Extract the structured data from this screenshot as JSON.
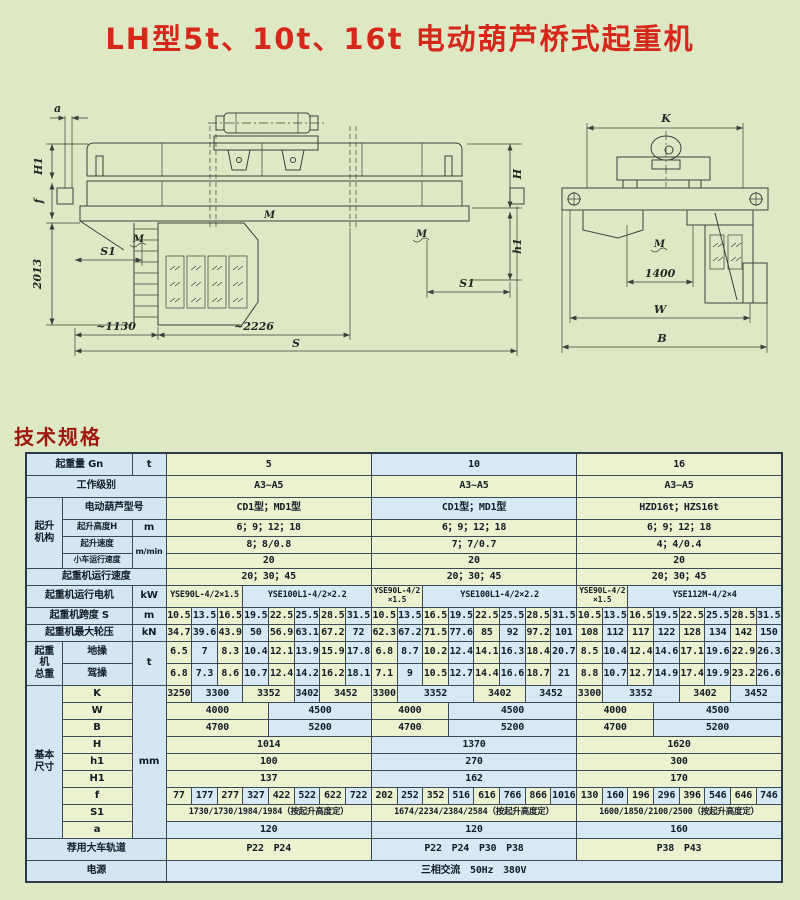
{
  "page": {
    "title": "LH型5t、10t、16t 电动葫芦桥式起重机",
    "section_heading": "技术规格"
  },
  "colors": {
    "page_bg": "#dfe8c5",
    "title_red": "#d6271b",
    "heading_red": "#9e170d",
    "cell_green": "#ecf1cf",
    "cell_blue": "#d6e9f4",
    "label_blue": "#d3e6f1",
    "border": "#3a4a57"
  },
  "drawing": {
    "left": {
      "a": "a",
      "h1dim": "H1",
      "f": "f",
      "d2013": "2013",
      "s1a": "S1",
      "s1b": "S1",
      "d1130": "~1130",
      "d2226": "~2226",
      "s": "S",
      "h": "H",
      "h1r": "h1",
      "m": "M"
    },
    "right": {
      "k": "K",
      "d1400": "1400",
      "w": "W",
      "b": "B",
      "m": "M"
    }
  },
  "table": {
    "rows": [
      [
        {
          "t": "起重量 Gn",
          "cs": 2,
          "c": "lab"
        },
        {
          "t": "t",
          "c": "lab"
        },
        {
          "t": "5",
          "cs": 8,
          "c": "g"
        },
        {
          "t": "10",
          "cs": 8,
          "c": "b"
        },
        {
          "t": "16",
          "cs": 8,
          "c": "g"
        }
      ],
      [
        {
          "t": "工作级别",
          "cs": 3,
          "c": "lab"
        },
        {
          "t": "A3~A5",
          "cs": 8,
          "c": "g"
        },
        {
          "t": "A3~A5",
          "cs": 8,
          "c": "g"
        },
        {
          "t": "A3~A5",
          "cs": 8,
          "c": "g"
        }
      ],
      [
        {
          "t": "起升\n机构",
          "rs": 4,
          "c": "lab"
        },
        {
          "t": "电动葫芦型号",
          "cs": 2,
          "c": "lab"
        },
        {
          "t": "CD1型；MD1型",
          "cs": 8,
          "c": "g"
        },
        {
          "t": "CD1型；MD1型",
          "cs": 8,
          "c": "b"
        },
        {
          "t": "HZD16t；HZS16t",
          "cs": 8,
          "c": "g"
        }
      ],
      [
        {
          "t": "起升高度H",
          "c": "lab sm"
        },
        {
          "t": "m",
          "c": "lab"
        },
        {
          "t": "6；9；12；18",
          "cs": 8,
          "c": "g"
        },
        {
          "t": "6；9；12；18",
          "cs": 8,
          "c": "g"
        },
        {
          "t": "6；9；12；18",
          "cs": 8,
          "c": "g"
        }
      ],
      [
        {
          "t": "起升速度",
          "c": "lab sm"
        },
        {
          "t": "m/min",
          "rs": 2,
          "c": "lab xs"
        },
        {
          "t": "8；8/0.8",
          "cs": 8,
          "c": "g"
        },
        {
          "t": "7；7/0.7",
          "cs": 8,
          "c": "g"
        },
        {
          "t": "4；4/0.4",
          "cs": 8,
          "c": "g"
        }
      ],
      [
        {
          "t": "小车运行速度",
          "c": "lab xs"
        },
        {
          "t": "20",
          "cs": 8,
          "c": "g"
        },
        {
          "t": "20",
          "cs": 8,
          "c": "g"
        },
        {
          "t": "20",
          "cs": 8,
          "c": "g"
        }
      ],
      [
        {
          "t": "起重机运行速度",
          "cs": 3,
          "c": "lab"
        },
        {
          "t": "20；30；45",
          "cs": 8,
          "c": "g"
        },
        {
          "t": "20；30；45",
          "cs": 8,
          "c": "g"
        },
        {
          "t": "20；30；45",
          "cs": 8,
          "c": "g"
        }
      ],
      [
        {
          "t": "起重机运行电机",
          "cs": 2,
          "c": "lab"
        },
        {
          "t": "kW",
          "c": "lab"
        },
        {
          "t": "YSE90L-4/2×1.5",
          "cs": 3,
          "c": "g sm"
        },
        {
          "t": "YSE100L1-4/2×2.2",
          "cs": 5,
          "c": "b sm"
        },
        {
          "t": "YSE90L-4/2\n×1.5",
          "cs": 2,
          "c": "g xs"
        },
        {
          "t": "YSE100L1-4/2×2.2",
          "cs": 6,
          "c": "b sm"
        },
        {
          "t": "YSE90L-4/2\n×1.5",
          "cs": 2,
          "c": "g xs"
        },
        {
          "t": "YSE112M-4/2×4",
          "cs": 6,
          "c": "b sm"
        }
      ],
      [
        {
          "t": "起重机跨度 S",
          "cs": 2,
          "c": "lab"
        },
        {
          "t": "m",
          "c": "lab"
        },
        {
          "t": "10.5",
          "c": "g"
        },
        {
          "t": "13.5",
          "c": "b"
        },
        {
          "t": "16.5",
          "c": "g"
        },
        {
          "t": "19.5",
          "c": "b"
        },
        {
          "t": "22.5",
          "c": "g"
        },
        {
          "t": "25.5",
          "c": "b"
        },
        {
          "t": "28.5",
          "c": "g"
        },
        {
          "t": "31.5",
          "c": "b"
        },
        {
          "t": "10.5",
          "c": "g"
        },
        {
          "t": "13.5",
          "c": "b"
        },
        {
          "t": "16.5",
          "c": "g"
        },
        {
          "t": "19.5",
          "c": "b"
        },
        {
          "t": "22.5",
          "c": "g"
        },
        {
          "t": "25.5",
          "c": "b"
        },
        {
          "t": "28.5",
          "c": "g"
        },
        {
          "t": "31.5",
          "c": "b"
        },
        {
          "t": "10.5",
          "c": "g"
        },
        {
          "t": "13.5",
          "c": "b"
        },
        {
          "t": "16.5",
          "c": "g"
        },
        {
          "t": "19.5",
          "c": "b"
        },
        {
          "t": "22.5",
          "c": "g"
        },
        {
          "t": "25.5",
          "c": "b"
        },
        {
          "t": "28.5",
          "c": "g"
        },
        {
          "t": "31.5",
          "c": "b"
        }
      ],
      [
        {
          "t": "起重机最大轮压",
          "cs": 2,
          "c": "lab"
        },
        {
          "t": "kN",
          "c": "lab"
        },
        {
          "t": "34.7",
          "c": "g"
        },
        {
          "t": "39.6",
          "c": "b"
        },
        {
          "t": "43.9",
          "c": "g"
        },
        {
          "t": "50",
          "c": "b"
        },
        {
          "t": "56.9",
          "c": "g"
        },
        {
          "t": "63.1",
          "c": "b"
        },
        {
          "t": "67.2",
          "c": "g"
        },
        {
          "t": "72",
          "c": "b"
        },
        {
          "t": "62.3",
          "c": "g"
        },
        {
          "t": "67.2",
          "c": "b"
        },
        {
          "t": "71.5",
          "c": "g"
        },
        {
          "t": "77.6",
          "c": "b"
        },
        {
          "t": "85",
          "c": "g"
        },
        {
          "t": "92",
          "c": "b"
        },
        {
          "t": "97.2",
          "c": "g"
        },
        {
          "t": "101",
          "c": "b"
        },
        {
          "t": "108",
          "c": "g"
        },
        {
          "t": "112",
          "c": "b"
        },
        {
          "t": "117",
          "c": "g"
        },
        {
          "t": "122",
          "c": "b"
        },
        {
          "t": "128",
          "c": "g"
        },
        {
          "t": "134",
          "c": "b"
        },
        {
          "t": "142",
          "c": "g"
        },
        {
          "t": "150",
          "c": "b"
        }
      ],
      [
        {
          "t": "起重\n机\n总重",
          "rs": 2,
          "c": "lab"
        },
        {
          "t": "地操",
          "c": "lab"
        },
        {
          "t": "t",
          "rs": 2,
          "c": "lab"
        },
        {
          "t": "6.5",
          "c": "g"
        },
        {
          "t": "7",
          "c": "b"
        },
        {
          "t": "8.3",
          "c": "g"
        },
        {
          "t": "10.4",
          "c": "b"
        },
        {
          "t": "12.1",
          "c": "g"
        },
        {
          "t": "13.9",
          "c": "b"
        },
        {
          "t": "15.9",
          "c": "g"
        },
        {
          "t": "17.8",
          "c": "b"
        },
        {
          "t": "6.8",
          "c": "g"
        },
        {
          "t": "8.7",
          "c": "b"
        },
        {
          "t": "10.2",
          "c": "g"
        },
        {
          "t": "12.4",
          "c": "b"
        },
        {
          "t": "14.1",
          "c": "g"
        },
        {
          "t": "16.3",
          "c": "b"
        },
        {
          "t": "18.4",
          "c": "g"
        },
        {
          "t": "20.7",
          "c": "b"
        },
        {
          "t": "8.5",
          "c": "g"
        },
        {
          "t": "10.4",
          "c": "b"
        },
        {
          "t": "12.4",
          "c": "g"
        },
        {
          "t": "14.6",
          "c": "b"
        },
        {
          "t": "17.1",
          "c": "g"
        },
        {
          "t": "19.6",
          "c": "b"
        },
        {
          "t": "22.9",
          "c": "g"
        },
        {
          "t": "26.3",
          "c": "b"
        }
      ],
      [
        {
          "t": "驾操",
          "c": "lab"
        },
        {
          "t": "6.8",
          "c": "g"
        },
        {
          "t": "7.3",
          "c": "b"
        },
        {
          "t": "8.6",
          "c": "g"
        },
        {
          "t": "10.7",
          "c": "b"
        },
        {
          "t": "12.4",
          "c": "g"
        },
        {
          "t": "14.2",
          "c": "b"
        },
        {
          "t": "16.2",
          "c": "g"
        },
        {
          "t": "18.1",
          "c": "b"
        },
        {
          "t": "7.1",
          "c": "g"
        },
        {
          "t": "9",
          "c": "b"
        },
        {
          "t": "10.5",
          "c": "g"
        },
        {
          "t": "12.7",
          "c": "b"
        },
        {
          "t": "14.4",
          "c": "g"
        },
        {
          "t": "16.6",
          "c": "b"
        },
        {
          "t": "18.7",
          "c": "g"
        },
        {
          "t": "21",
          "c": "b"
        },
        {
          "t": "8.8",
          "c": "g"
        },
        {
          "t": "10.7",
          "c": "b"
        },
        {
          "t": "12.7",
          "c": "g"
        },
        {
          "t": "14.9",
          "c": "b"
        },
        {
          "t": "17.4",
          "c": "g"
        },
        {
          "t": "19.9",
          "c": "b"
        },
        {
          "t": "23.2",
          "c": "g"
        },
        {
          "t": "26.6",
          "c": "b"
        }
      ],
      [
        {
          "t": "基本\n尺寸",
          "rs": 9,
          "c": "lab"
        },
        {
          "t": "K",
          "c": "labg"
        },
        {
          "t": "mm",
          "rs": 9,
          "c": "lab"
        },
        {
          "t": "3250",
          "c": "g"
        },
        {
          "t": "3300",
          "cs": 2,
          "c": "b"
        },
        {
          "t": "3352",
          "cs": 2,
          "c": "g"
        },
        {
          "t": "3402",
          "c": "b"
        },
        {
          "t": "3452",
          "cs": 2,
          "c": "g"
        },
        {
          "t": "3300",
          "c": "g"
        },
        {
          "t": "3352",
          "cs": 3,
          "c": "b"
        },
        {
          "t": "3402",
          "cs": 2,
          "c": "g"
        },
        {
          "t": "3452",
          "cs": 2,
          "c": "b"
        },
        {
          "t": "3300",
          "c": "g"
        },
        {
          "t": "3352",
          "cs": 3,
          "c": "b"
        },
        {
          "t": "3402",
          "cs": 2,
          "c": "g"
        },
        {
          "t": "3452",
          "cs": 2,
          "c": "b"
        }
      ],
      [
        {
          "t": "W",
          "c": "labg"
        },
        {
          "t": "4000",
          "cs": 4,
          "c": "g"
        },
        {
          "t": "4500",
          "cs": 4,
          "c": "b"
        },
        {
          "t": "4000",
          "cs": 3,
          "c": "g"
        },
        {
          "t": "4500",
          "cs": 5,
          "c": "b"
        },
        {
          "t": "4000",
          "cs": 3,
          "c": "g"
        },
        {
          "t": "4500",
          "cs": 5,
          "c": "b"
        }
      ],
      [
        {
          "t": "B",
          "c": "labg"
        },
        {
          "t": "4700",
          "cs": 4,
          "c": "g"
        },
        {
          "t": "5200",
          "cs": 4,
          "c": "b"
        },
        {
          "t": "4700",
          "cs": 3,
          "c": "g"
        },
        {
          "t": "5200",
          "cs": 5,
          "c": "b"
        },
        {
          "t": "4700",
          "cs": 3,
          "c": "g"
        },
        {
          "t": "5200",
          "cs": 5,
          "c": "b"
        }
      ],
      [
        {
          "t": "H",
          "c": "labg"
        },
        {
          "t": "1014",
          "cs": 8,
          "c": "g"
        },
        {
          "t": "1370",
          "cs": 8,
          "c": "b"
        },
        {
          "t": "1620",
          "cs": 8,
          "c": "g"
        }
      ],
      [
        {
          "t": "h1",
          "c": "labg"
        },
        {
          "t": "100",
          "cs": 8,
          "c": "g"
        },
        {
          "t": "270",
          "cs": 8,
          "c": "b"
        },
        {
          "t": "300",
          "cs": 8,
          "c": "g"
        }
      ],
      [
        {
          "t": "H1",
          "c": "labg"
        },
        {
          "t": "137",
          "cs": 8,
          "c": "g"
        },
        {
          "t": "162",
          "cs": 8,
          "c": "b"
        },
        {
          "t": "170",
          "cs": 8,
          "c": "g"
        }
      ],
      [
        {
          "t": "f",
          "c": "labg"
        },
        {
          "t": "77",
          "c": "g"
        },
        {
          "t": "177",
          "c": "b"
        },
        {
          "t": "277",
          "c": "g"
        },
        {
          "t": "327",
          "c": "b"
        },
        {
          "t": "422",
          "c": "g"
        },
        {
          "t": "522",
          "c": "b"
        },
        {
          "t": "622",
          "c": "g"
        },
        {
          "t": "722",
          "c": "b"
        },
        {
          "t": "202",
          "c": "g"
        },
        {
          "t": "252",
          "c": "b"
        },
        {
          "t": "352",
          "c": "g"
        },
        {
          "t": "516",
          "c": "b"
        },
        {
          "t": "616",
          "c": "g"
        },
        {
          "t": "766",
          "c": "b"
        },
        {
          "t": "866",
          "c": "g"
        },
        {
          "t": "1016",
          "c": "b"
        },
        {
          "t": "130",
          "c": "g"
        },
        {
          "t": "160",
          "c": "b"
        },
        {
          "t": "196",
          "c": "g"
        },
        {
          "t": "296",
          "c": "b"
        },
        {
          "t": "396",
          "c": "g"
        },
        {
          "t": "546",
          "c": "b"
        },
        {
          "t": "646",
          "c": "g"
        },
        {
          "t": "746",
          "c": "b"
        }
      ],
      [
        {
          "t": "S1",
          "c": "labg"
        },
        {
          "t": "1730/1730/1984/1984（按起升高度定）",
          "cs": 8,
          "c": "g sm"
        },
        {
          "t": "1674/2234/2384/2584（按起升高度定）",
          "cs": 8,
          "c": "g sm"
        },
        {
          "t": "1600/1850/2100/2500（按起升高度定）",
          "cs": 8,
          "c": "g sm"
        }
      ],
      [
        {
          "t": "a",
          "c": "labg"
        },
        {
          "t": "120",
          "cs": 8,
          "c": "b"
        },
        {
          "t": "120",
          "cs": 8,
          "c": "b"
        },
        {
          "t": "160",
          "cs": 8,
          "c": "b"
        }
      ],
      [
        {
          "t": "荐用大车轨道",
          "cs": 3,
          "c": "lab"
        },
        {
          "t": "P22　P24",
          "cs": 8,
          "c": "g"
        },
        {
          "t": "P22　P24　P30　P38",
          "cs": 8,
          "c": "b"
        },
        {
          "t": "P38　P43",
          "cs": 8,
          "c": "g"
        }
      ],
      [
        {
          "t": "电源",
          "cs": 3,
          "c": "lab"
        },
        {
          "t": "三相交流　50Hz　380V",
          "cs": 24,
          "c": "b"
        }
      ]
    ]
  }
}
